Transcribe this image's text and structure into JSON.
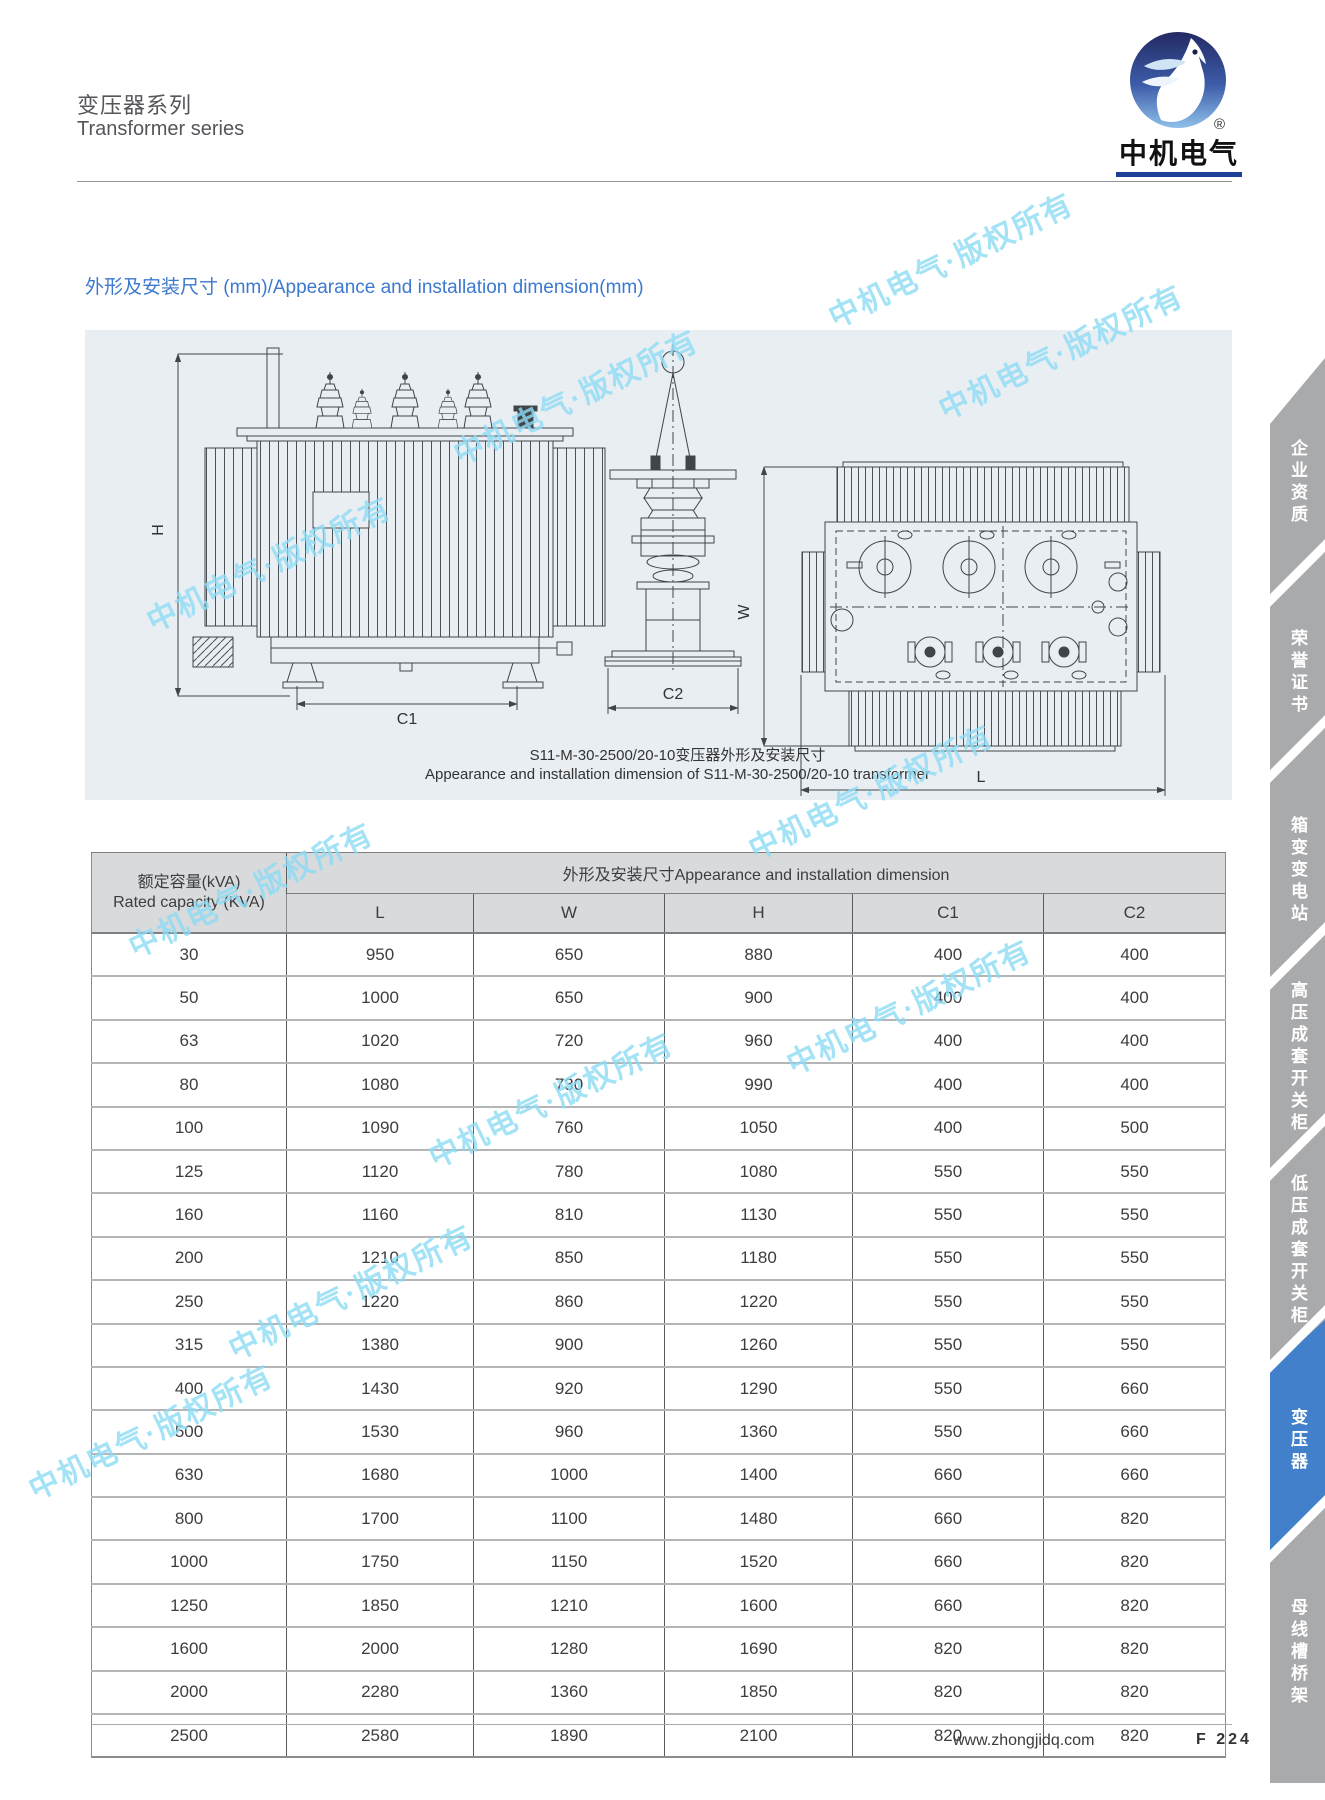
{
  "header": {
    "title_zh": "变压器系列",
    "title_en": "Transformer series",
    "logo_text": "中机电气",
    "registered_mark": "®"
  },
  "section": {
    "heading": "外形及安装尺寸 (mm)/Appearance and installation dimension(mm)"
  },
  "drawing": {
    "caption_zh": "S11-M-30-2500/20-10变压器外形及安装尺寸",
    "caption_en": "Appearance and installation dimension of S11-M-30-2500/20-10 transformer",
    "dim_labels": {
      "h": "H",
      "c1": "C1",
      "c2": "C2",
      "w": "W",
      "l": "L"
    }
  },
  "table": {
    "col_capacity_zh": "额定容量(kVA)",
    "col_capacity_en": "Rated capacity (KVA)",
    "group_header": "外形及安装尺寸Appearance and installation dimension",
    "columns": [
      "L",
      "W",
      "H",
      "C1",
      "C2"
    ],
    "rows": [
      [
        "30",
        "950",
        "650",
        "880",
        "400",
        "400"
      ],
      [
        "50",
        "1000",
        "650",
        "900",
        "400",
        "400"
      ],
      [
        "63",
        "1020",
        "720",
        "960",
        "400",
        "400"
      ],
      [
        "80",
        "1080",
        "730",
        "990",
        "400",
        "400"
      ],
      [
        "100",
        "1090",
        "760",
        "1050",
        "400",
        "500"
      ],
      [
        "125",
        "1120",
        "780",
        "1080",
        "550",
        "550"
      ],
      [
        "160",
        "1160",
        "810",
        "1130",
        "550",
        "550"
      ],
      [
        "200",
        "1210",
        "850",
        "1180",
        "550",
        "550"
      ],
      [
        "250",
        "1220",
        "860",
        "1220",
        "550",
        "550"
      ],
      [
        "315",
        "1380",
        "900",
        "1260",
        "550",
        "550"
      ],
      [
        "400",
        "1430",
        "920",
        "1290",
        "550",
        "660"
      ],
      [
        "500",
        "1530",
        "960",
        "1360",
        "550",
        "660"
      ],
      [
        "630",
        "1680",
        "1000",
        "1400",
        "660",
        "660"
      ],
      [
        "800",
        "1700",
        "1100",
        "1480",
        "660",
        "820"
      ],
      [
        "1000",
        "1750",
        "1150",
        "1520",
        "660",
        "820"
      ],
      [
        "1250",
        "1850",
        "1210",
        "1600",
        "660",
        "820"
      ],
      [
        "1600",
        "2000",
        "1280",
        "1690",
        "820",
        "820"
      ],
      [
        "2000",
        "2280",
        "1360",
        "1850",
        "820",
        "820"
      ],
      [
        "2500",
        "2580",
        "1890",
        "2100",
        "820",
        "820"
      ]
    ]
  },
  "sidebar": {
    "tabs": [
      {
        "label": "企业资质",
        "active": false
      },
      {
        "label": "荣誉证书",
        "active": false
      },
      {
        "label": "箱变变电站",
        "active": false
      },
      {
        "label": "高压成套开关柜",
        "active": false
      },
      {
        "label": "低压成套开关柜",
        "active": false
      },
      {
        "label": "变压器",
        "active": true
      },
      {
        "label": "母线槽桥架",
        "active": false
      }
    ]
  },
  "footer": {
    "website": "www.zhongjidq.com",
    "page": "F 224"
  },
  "watermark": {
    "text": "中机电气·版权所有",
    "color": "#8edcf5"
  },
  "colors": {
    "accent_blue": "#3c79cf",
    "sidebar_gray": "#a9aaac",
    "sidebar_active_blue": "#4280cb",
    "panel_bg": "#e9eef3",
    "table_header_bg": "#d9dadb",
    "watermark_blue": "#8edcf5",
    "logo_navy": "#232a63",
    "logo_light_blue": "#8fc0ea",
    "logo_bar_blue": "#1d3f98"
  }
}
